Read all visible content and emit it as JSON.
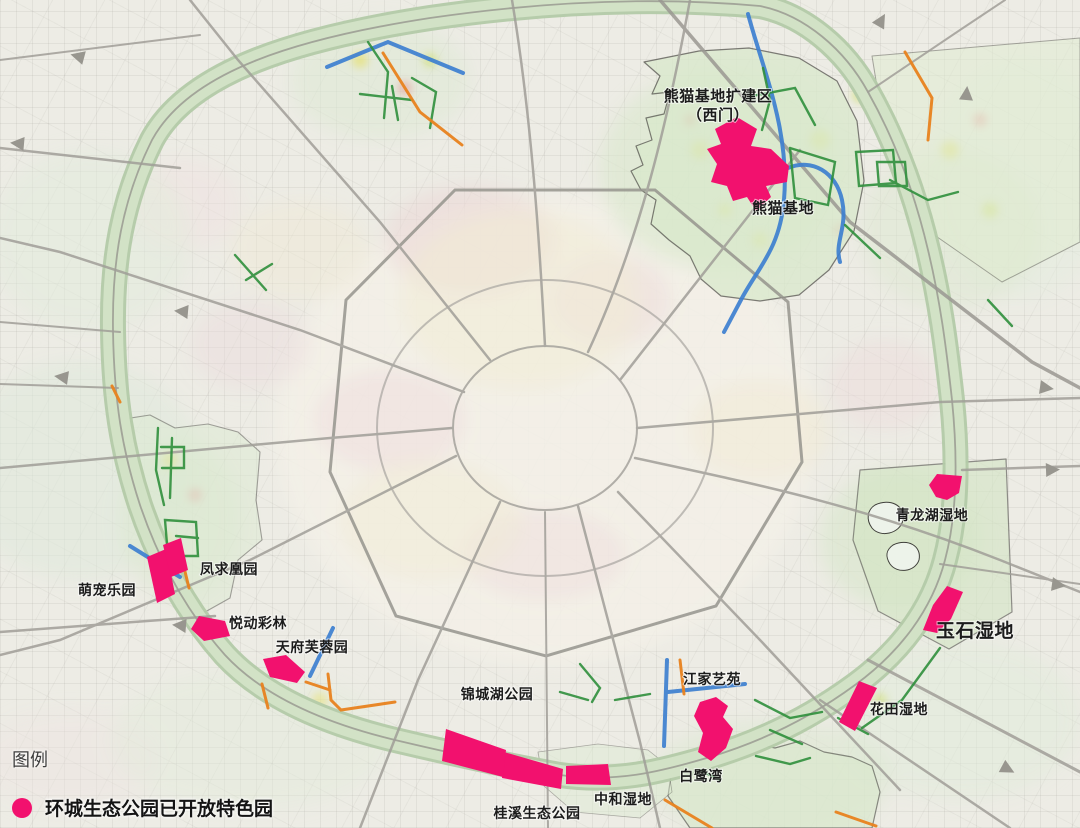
{
  "legend": {
    "title": "图例",
    "items": [
      {
        "label": "环城生态公园已开放特色园",
        "marker": "park-dot"
      }
    ]
  },
  "colors": {
    "park": "#F2116E",
    "ring_band": "#d2e2c6",
    "river": "#3d7fd0",
    "trail_green": "#2f8f3c",
    "trail_orange": "#e8821e",
    "road": "#a09e98",
    "boundary": "#4f4f49",
    "background": "#edece5",
    "label_text": "#1c1c1c"
  },
  "parks": [
    {
      "id": "xiongmao-jidi-kuojianqu",
      "name": "熊猫基地扩建区（西门）",
      "label": {
        "lines": [
          "熊猫基地扩建区",
          "（西门）"
        ],
        "x": 718,
        "y": 101,
        "size": 15
      },
      "polygons": [
        [
          [
            737,
            117
          ],
          [
            757,
            129
          ],
          [
            751,
            146
          ],
          [
            771,
            149
          ],
          [
            789,
            166
          ],
          [
            787,
            182
          ],
          [
            766,
            186
          ],
          [
            771,
            197
          ],
          [
            756,
            211
          ],
          [
            747,
            197
          ],
          [
            733,
            201
          ],
          [
            727,
            186
          ],
          [
            711,
            182
          ],
          [
            717,
            164
          ],
          [
            707,
            149
          ],
          [
            721,
            144
          ],
          [
            715,
            129
          ]
        ]
      ]
    },
    {
      "id": "xiongmao-jidi",
      "name": "熊猫基地",
      "label": {
        "text": "熊猫基地",
        "x": 783,
        "y": 213,
        "size": 15
      },
      "polygons": []
    },
    {
      "id": "qinglonghu-shidi",
      "name": "青龙湖湿地",
      "label": {
        "text": "青龙湖湿地",
        "x": 932,
        "y": 520,
        "size": 14
      },
      "polygons": [
        [
          [
            937,
            474
          ],
          [
            962,
            476
          ],
          [
            959,
            493
          ],
          [
            947,
            500
          ],
          [
            936,
            497
          ],
          [
            929,
            485
          ]
        ]
      ]
    },
    {
      "id": "yushi-shidi",
      "name": "玉石湿地",
      "label": {
        "text": "玉石湿地",
        "x": 975,
        "y": 637,
        "size": 19
      },
      "polygons": [
        [
          [
            947,
            586
          ],
          [
            963,
            592
          ],
          [
            951,
            619
          ],
          [
            937,
            633
          ],
          [
            923,
            630
          ],
          [
            933,
            605
          ]
        ]
      ]
    },
    {
      "id": "huatian-shidi",
      "name": "花田湿地",
      "label": {
        "text": "花田湿地",
        "x": 899,
        "y": 714,
        "size": 14
      },
      "polygons": [
        [
          [
            859,
            681
          ],
          [
            877,
            688
          ],
          [
            855,
            731
          ],
          [
            839,
            722
          ]
        ]
      ]
    },
    {
      "id": "jiangjia-yiyuan",
      "name": "江家艺苑",
      "label": {
        "text": "江家艺苑",
        "x": 712,
        "y": 684,
        "size": 14
      },
      "polygons": [
        [
          [
            700,
            702
          ],
          [
            716,
            697
          ],
          [
            728,
            706
          ],
          [
            723,
            717
          ],
          [
            733,
            729
          ],
          [
            726,
            748
          ],
          [
            711,
            761
          ],
          [
            698,
            752
          ],
          [
            703,
            733
          ],
          [
            694,
            716
          ]
        ]
      ]
    },
    {
      "id": "bailuwan",
      "name": "白鹭湾",
      "label": {
        "text": "白鹭湾",
        "x": 701,
        "y": 781,
        "size": 14
      },
      "polygons": []
    },
    {
      "id": "zhonghe-shidi",
      "name": "中和湿地",
      "label": {
        "text": "中和湿地",
        "x": 623,
        "y": 804,
        "size": 14
      },
      "polygons": [
        [
          [
            566,
            766
          ],
          [
            608,
            764
          ],
          [
            611,
            785
          ],
          [
            566,
            784
          ]
        ]
      ]
    },
    {
      "id": "guixi-shengtai-gongyuan",
      "name": "桂溪生态公园",
      "label": {
        "text": "桂溪生态公园",
        "x": 537,
        "y": 818,
        "size": 14
      },
      "polygons": [
        [
          [
            504,
            752
          ],
          [
            563,
            769
          ],
          [
            561,
            789
          ],
          [
            502,
            778
          ]
        ]
      ]
    },
    {
      "id": "jinchenghu-gongyuan",
      "name": "锦城湖公园",
      "label": {
        "text": "锦城湖公园",
        "x": 497,
        "y": 699,
        "size": 14
      },
      "polygons": [
        [
          [
            446,
            729
          ],
          [
            506,
            750
          ],
          [
            503,
            777
          ],
          [
            442,
            761
          ]
        ]
      ]
    },
    {
      "id": "fengqiuhuang-yuan",
      "name": "凤求凰园",
      "label": {
        "text": "凤求凰园",
        "x": 229,
        "y": 574,
        "size": 14
      },
      "polygons": [
        [
          [
            147,
            557
          ],
          [
            166,
            549
          ],
          [
            175,
            594
          ],
          [
            157,
            603
          ]
        ],
        [
          [
            163,
            545
          ],
          [
            181,
            538
          ],
          [
            188,
            570
          ],
          [
            171,
            577
          ]
        ]
      ]
    },
    {
      "id": "mengchong-leyuan",
      "name": "萌宠乐园",
      "label": {
        "text": "萌宠乐园",
        "x": 107,
        "y": 595,
        "size": 14
      },
      "polygons": []
    },
    {
      "id": "yuedong-cailin",
      "name": "悦动彩林",
      "label": {
        "text": "悦动彩林",
        "x": 258,
        "y": 628,
        "size": 14
      },
      "polygons": [
        [
          [
            199,
            616
          ],
          [
            225,
            621
          ],
          [
            230,
            636
          ],
          [
            204,
            641
          ],
          [
            191,
            629
          ]
        ]
      ]
    },
    {
      "id": "tianfu-furongyuan",
      "name": "天府芙蓉园",
      "label": {
        "text": "天府芙蓉园",
        "x": 312,
        "y": 652,
        "size": 14
      },
      "polygons": [
        [
          [
            263,
            659
          ],
          [
            286,
            655
          ],
          [
            305,
            672
          ],
          [
            297,
            683
          ],
          [
            270,
            677
          ]
        ]
      ]
    }
  ]
}
